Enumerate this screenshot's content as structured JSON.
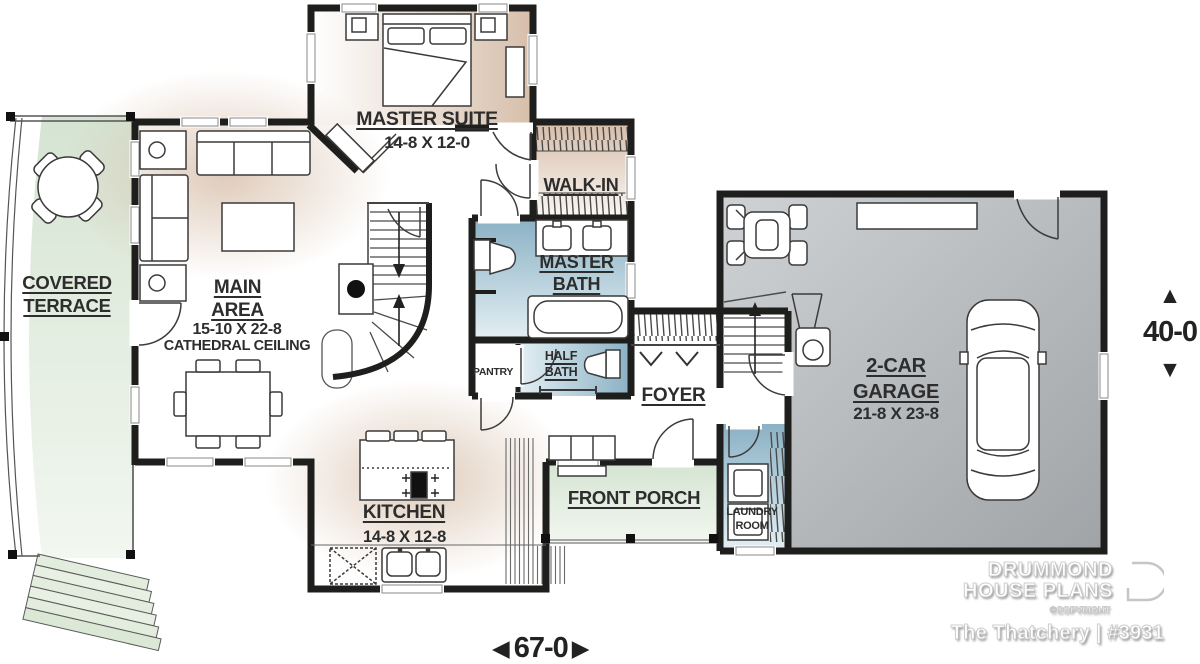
{
  "rooms": {
    "covered_terrace": {
      "name": "COVERED TERRACE"
    },
    "master_suite": {
      "name": "MASTER SUITE",
      "dims": "14-8 X 12-0"
    },
    "main_area": {
      "name": "MAIN AREA",
      "dims": "15-10 X 22-8",
      "note": "CATHEDRAL CEILING"
    },
    "walk_in": {
      "name": "WALK-IN"
    },
    "master_bath": {
      "name": "MASTER BATH"
    },
    "pantry": {
      "name": "PANTRY"
    },
    "half_bath": {
      "name": "HALF BATH"
    },
    "foyer": {
      "name": "FOYER"
    },
    "front_porch": {
      "name": "FRONT PORCH"
    },
    "kitchen": {
      "name": "KITCHEN",
      "dims": "14-8 X 12-8"
    },
    "laundry_room": {
      "name": "LAUNDRY ROOM"
    },
    "garage": {
      "name": "2-CAR GARAGE",
      "dims": "21-8 X 23-8"
    }
  },
  "dimensions": {
    "width": "67-0",
    "depth": "40-0",
    "arrow_left": "◀",
    "arrow_right": "▶",
    "arrow_up": "▲",
    "arrow_down": "▼"
  },
  "branding": {
    "line1": "DRUMMOND",
    "line2": "HOUSE PLANS",
    "copyright": "©COPYRIGHT",
    "plan_title": "The Thatchery | #3931"
  },
  "colors": {
    "wall": "#1e1e1c",
    "tan": "#d7bfab",
    "blue": "#8ab1c4",
    "green": "#d5e4d2",
    "garage_gray": "#b4b7ba",
    "label": "#2d2d2d"
  }
}
